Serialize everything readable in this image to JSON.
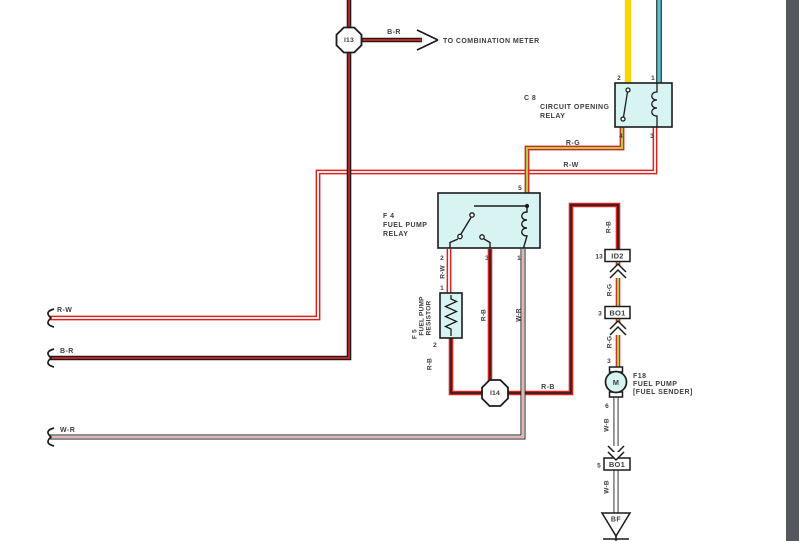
{
  "colors": {
    "bg": "#ffffff",
    "red": "#d82420",
    "red_soft": "#cc6a66",
    "green": "#a8d24e",
    "yellow": "#f6d607",
    "cyan": "#5ac4d4",
    "box_fill": "#d7f4f3",
    "ink": "#1c1c1c",
    "text": "#3e3e3e",
    "white": "#ffffff",
    "panel_gray": "#54585c"
  },
  "labels": {
    "rw": "R-W",
    "rb": "R-B",
    "rg": "R-G",
    "br": "B-R",
    "wr": "W-R",
    "wb": "W-B"
  },
  "junctions": {
    "i13": "I13",
    "i14": "I14"
  },
  "meter_note": "TO COMBINATION METER",
  "c8": {
    "code": "C 8",
    "name_line1": "CIRCUIT OPENING",
    "name_line2": "RELAY",
    "pin2": "2",
    "pin1": "1",
    "pin4": "4",
    "pin3": "3"
  },
  "f4": {
    "code": "F 4",
    "name_line1": "FUEL PUMP",
    "name_line2": "RELAY",
    "pin5": "5",
    "pin2": "2",
    "pin3": "3",
    "pin1": "1"
  },
  "f5": {
    "code": "F 5",
    "name_line1": "FUEL PUMP",
    "name_line2": "RESISTOR",
    "pin1": "1",
    "pin2": "2"
  },
  "f18": {
    "code": "F18",
    "name_line1": "FUEL PUMP",
    "name_line2": "[FUEL SENDER]",
    "motor_letter": "M",
    "pin3": "3",
    "pin6": "6"
  },
  "connectors": {
    "id2_pin": "13",
    "id2": "ID2",
    "bo1_upper_pin": "3",
    "bo1_upper": "BO1",
    "bo1_lower_pin": "5",
    "bo1_lower": "BO1"
  },
  "ground": {
    "bf": "BF"
  }
}
